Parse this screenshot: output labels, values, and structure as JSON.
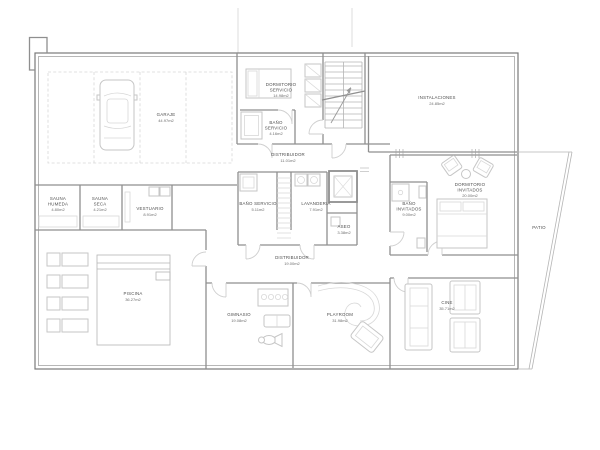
{
  "colors": {
    "background": "#ffffff",
    "exterior_wall": "#7a7a7a",
    "interior_wall": "#8f8f8f",
    "furniture_line": "#c6c6c6",
    "label_text": "#4f4f4f"
  },
  "icons": {
    "car": "top-view-car-outline",
    "stairs": "stair-treads-with-arrow",
    "elevator": "nested-squares",
    "bed": "bed-outline",
    "sofa": "sofa-outline",
    "slide": "spiral-slide-curve",
    "lounger": "pool-lounger-rects",
    "washer": "square-with-circle"
  },
  "rooms": {
    "garaje": {
      "name": "GARAJE",
      "area": "44.97m2"
    },
    "dormitorio_servicio": {
      "name": "DORMITORIO",
      "name2": "SERVICIO",
      "area": "14.98m2"
    },
    "bano_dormitorio_servicio": {
      "name": "BAÑO",
      "name2": "SERVICIO",
      "area": "4.16m2"
    },
    "distribuidor_norte": {
      "name": "DISTRIBUIDOR",
      "area": "11.01m2"
    },
    "instalaciones": {
      "name": "INSTALACIONES",
      "area": "24.85m2"
    },
    "bano_servicio": {
      "name": "BAÑO SERVICIO",
      "area": "5.11m2"
    },
    "lavanderia": {
      "name": "LAVANDERIA",
      "area": "7.91m2"
    },
    "aseo": {
      "name": "ASEO",
      "area": "3.38m2"
    },
    "distribuidor": {
      "name": "DISTRIBUIDOR",
      "area": "19.00m2"
    },
    "bano_invitados": {
      "name": "BAÑO",
      "name2": "INVITADOS",
      "area": "9.00m2"
    },
    "dormitorio_invitados": {
      "name": "DORMITORIO",
      "name2": "INVITADOS",
      "area": "20.00m2"
    },
    "sauna_humeda": {
      "name": "SAUNA",
      "name2": "HUMEDA",
      "area": "4.80m2"
    },
    "sauna_seca": {
      "name": "SAUNA",
      "name2": "SECA",
      "area": "4.21m2"
    },
    "vestuario": {
      "name": "VESTUARIO",
      "area": "8.91m2"
    },
    "piscina": {
      "name": "PISCINA",
      "area": "36.27m2"
    },
    "gimnasio": {
      "name": "GIMNASIO",
      "area": "19.08m2"
    },
    "playroom": {
      "name": "PLAYROOM",
      "area": "31.98m2"
    },
    "cine": {
      "name": "CINE",
      "area": "35.71m2"
    },
    "patio": {
      "name": "PATIO"
    }
  }
}
